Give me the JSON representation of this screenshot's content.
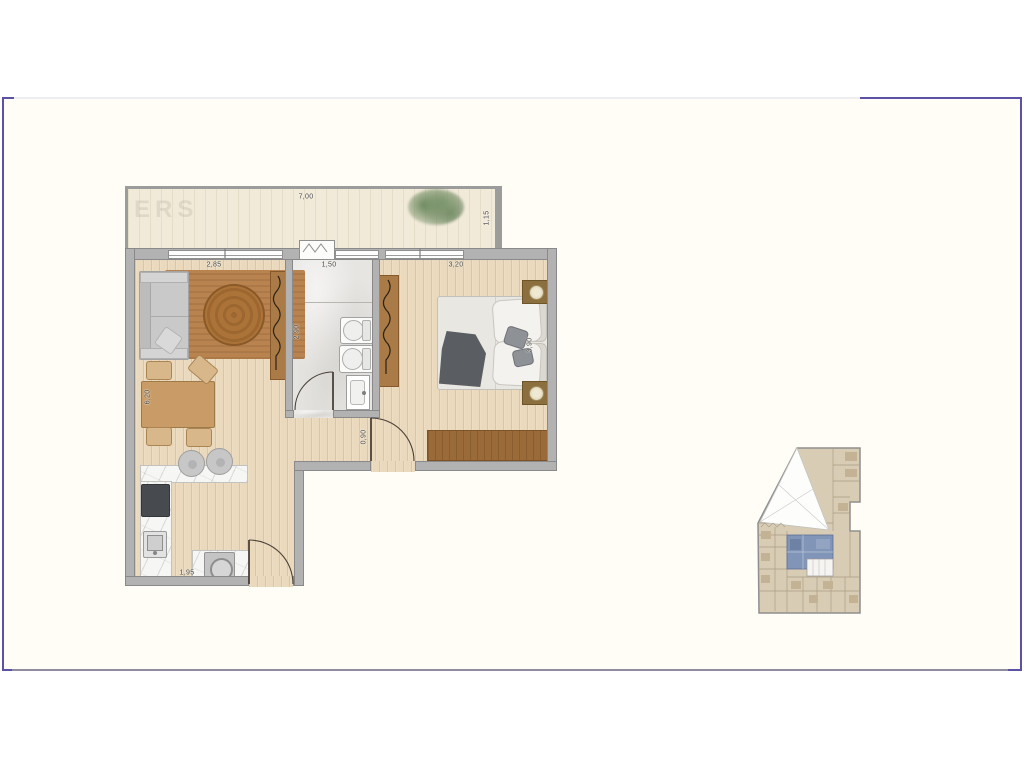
{
  "frame": {
    "border_color": "#5b51a5",
    "background": "#fffdf6"
  },
  "floorplan": {
    "watermark": "ERS",
    "dimensions": {
      "terrace_width": "7,00",
      "terrace_depth": "1,15",
      "living_width": "2,85",
      "bathroom_width": "1,50",
      "bedroom_width": "3,20",
      "living_depth": "6,20",
      "bathroom_depth": "2,90",
      "hall_width": "0,90",
      "bedroom_depth": "3,90",
      "kitchen_width": "1,95"
    },
    "colors": {
      "wall": "#b2b2b2",
      "wood_floor": "#ead9bc",
      "terrace_deck": "#f1ead9",
      "bathroom_marble": "#e6e5e2",
      "living_rug": "#b9834f",
      "wardrobe": "#aa7b46",
      "bedroom_runner": "#9b6a39"
    }
  },
  "keyplan": {
    "building_fill": "#d9ccb4",
    "unit_highlight": "#8095b8"
  }
}
